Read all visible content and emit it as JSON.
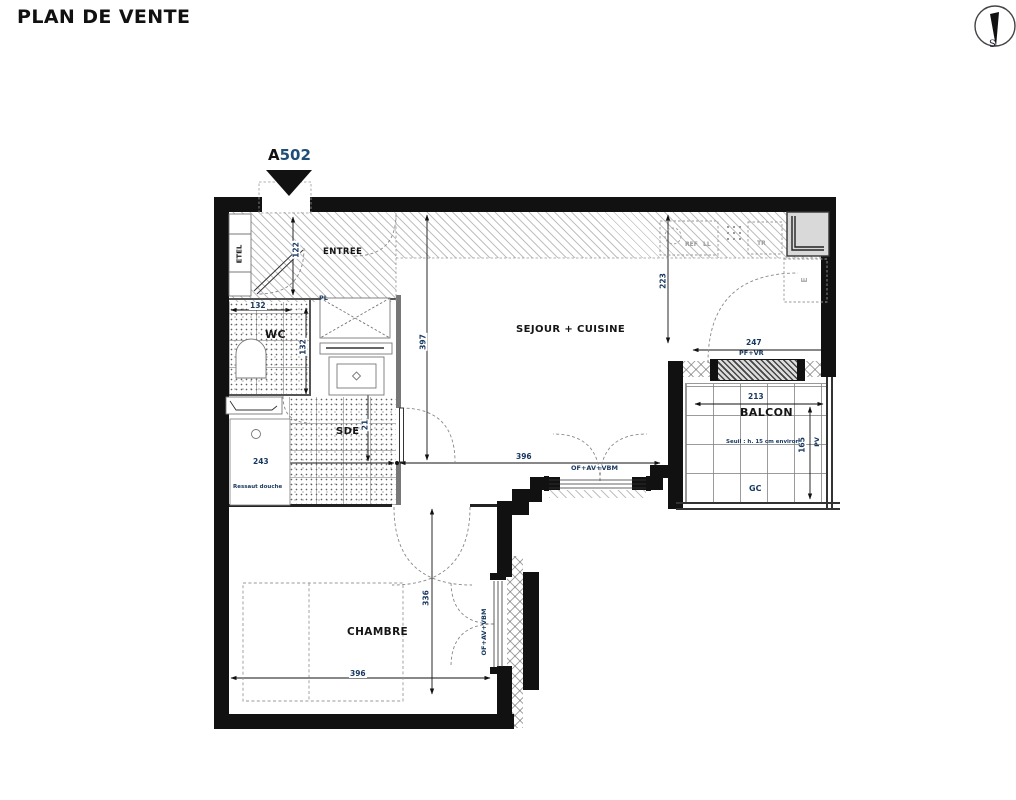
{
  "title": "PLAN DE VENTE",
  "unit": {
    "prefix": "A",
    "number": "502"
  },
  "compass": {
    "south": "S"
  },
  "rooms": {
    "entree": "ENTREE",
    "wc": "WC",
    "sde": "SDE",
    "sejour_cuisine": "SEJOUR + CUISINE",
    "chambre": "CHAMBRE",
    "balcon": "BALCON"
  },
  "annotations": {
    "etel": "ETEL",
    "placard": "PL",
    "refrigerator": "REF",
    "washing_machine": "LL",
    "sorting": "TR",
    "appliance": "E",
    "balcony_door": "PF+VR",
    "window_sejour": "OF+AV+VBM",
    "window_chambre": "OF+AV+VBM",
    "balcony_pv": "PV",
    "balcony_gc": "GC",
    "shower_note": "Ressaut douche",
    "threshold_note": "Seuil : h. 15 cm environ"
  },
  "dimensions": {
    "entry_door": "122",
    "wc_width": "132",
    "wc_depth": "132",
    "hall_segment": "21",
    "sde_width": "243",
    "sejour_depth": "397",
    "kitchen_depth": "223",
    "sejour_width": "396",
    "balcony_front": "247",
    "balcony_width": "213",
    "balcony_depth": "165",
    "chambre_depth": "336",
    "chambre_width": "396"
  }
}
